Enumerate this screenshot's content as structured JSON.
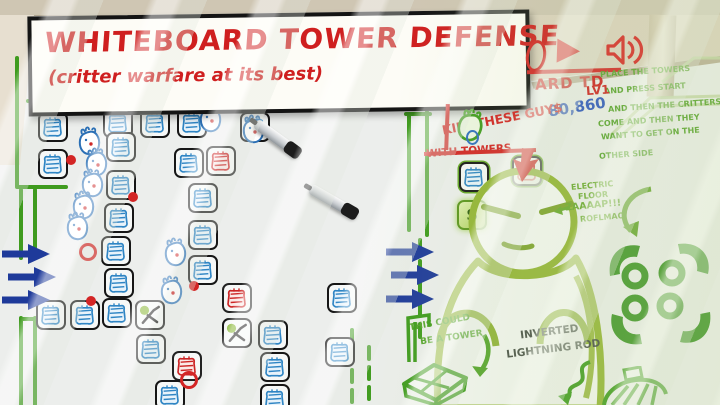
{
  "banner": {
    "title": "WHITEBOARD TOWER DEFENSE",
    "subtitle": "(critter warfare at its best)"
  },
  "hud": {
    "partial_board_label": "ARD TD",
    "score": "80,860",
    "kill_label": "KILL THESE GUY$",
    "with_label": "WITH TOWERS",
    "play_icon": "play-triangle",
    "sound_icon": "speaker-waves"
  },
  "instructions": {
    "level_label": "LV1",
    "lines": [
      "PLACE THE TOWERS",
      "AND PRESS START",
      "AND THEN THE CRITTERS",
      "COME AND THEN THEY",
      "WANT TO GET ON THE",
      "OTHER SIDE"
    ]
  },
  "annotations": {
    "electric_lines": [
      "ELECTRIC",
      "FLOOR",
      "ZAAAAP!!!",
      "ROFLMAO"
    ],
    "tower_idea_lines": [
      "THIS COULD",
      "BE A TOWER"
    ],
    "lightning_lines": [
      "INVERTED",
      "LIGHTNING ROD"
    ]
  },
  "palette": {
    "money_symbol": "$",
    "buttons": [
      {
        "x": 459,
        "y": 162,
        "t": "b"
      },
      {
        "x": 512,
        "y": 156,
        "t": "r"
      },
      {
        "x": 457,
        "y": 200,
        "t": "m"
      }
    ]
  },
  "colors": {
    "marker_red": "#d32525",
    "marker_blue": "#2f85c4",
    "marker_green": "#3f9b1e",
    "doodle_green": "#93b434",
    "score_blue": "#2d56c0",
    "arrow_navy": "#1e3a9a",
    "frame_beige": "#dcd2bf"
  },
  "board": {
    "towers": [
      {
        "x": 38,
        "y": 112,
        "t": "b"
      },
      {
        "x": 103,
        "y": 108,
        "t": "b"
      },
      {
        "x": 140,
        "y": 108,
        "t": "b"
      },
      {
        "x": 177,
        "y": 108,
        "t": "b"
      },
      {
        "x": 240,
        "y": 112,
        "t": "b"
      },
      {
        "x": 38,
        "y": 149,
        "t": "b"
      },
      {
        "x": 106,
        "y": 132,
        "t": "b"
      },
      {
        "x": 174,
        "y": 148,
        "t": "b"
      },
      {
        "x": 206,
        "y": 146,
        "t": "r"
      },
      {
        "x": 106,
        "y": 170,
        "t": "b"
      },
      {
        "x": 188,
        "y": 183,
        "t": "b"
      },
      {
        "x": 104,
        "y": 203,
        "t": "b"
      },
      {
        "x": 188,
        "y": 220,
        "t": "b"
      },
      {
        "x": 101,
        "y": 236,
        "t": "b"
      },
      {
        "x": 188,
        "y": 255,
        "t": "b"
      },
      {
        "x": 104,
        "y": 268,
        "t": "b"
      },
      {
        "x": 222,
        "y": 283,
        "t": "r"
      },
      {
        "x": 135,
        "y": 300,
        "t": "s"
      },
      {
        "x": 222,
        "y": 318,
        "t": "s"
      },
      {
        "x": 258,
        "y": 320,
        "t": "b"
      },
      {
        "x": 136,
        "y": 334,
        "t": "b"
      },
      {
        "x": 172,
        "y": 351,
        "t": "r"
      },
      {
        "x": 260,
        "y": 352,
        "t": "b"
      },
      {
        "x": 155,
        "y": 380,
        "t": "b"
      },
      {
        "x": 260,
        "y": 384,
        "t": "b"
      },
      {
        "x": 327,
        "y": 283,
        "t": "b"
      },
      {
        "x": 325,
        "y": 337,
        "t": "b"
      },
      {
        "x": 36,
        "y": 300,
        "t": "b"
      },
      {
        "x": 70,
        "y": 300,
        "t": "b"
      },
      {
        "x": 102,
        "y": 298,
        "t": "b"
      }
    ],
    "critters": [
      [
        197,
        103
      ],
      [
        240,
        114
      ],
      [
        76,
        126
      ],
      [
        83,
        147
      ],
      [
        79,
        168
      ],
      [
        70,
        190
      ],
      [
        64,
        211
      ],
      [
        162,
        237
      ],
      [
        158,
        275
      ]
    ],
    "projectiles": [
      {
        "x": 66,
        "y": 155,
        "ring": false
      },
      {
        "x": 128,
        "y": 192,
        "ring": false
      },
      {
        "x": 86,
        "y": 296,
        "ring": false
      },
      {
        "x": 189,
        "y": 281,
        "ring": false
      },
      {
        "x": 79,
        "y": 243,
        "ring": true
      },
      {
        "x": 180,
        "y": 371,
        "ring": true
      }
    ],
    "entry_arrows": [
      [
        0,
        243
      ],
      [
        6,
        266
      ],
      [
        0,
        289
      ]
    ],
    "exit_arrows": [
      [
        384,
        241
      ],
      [
        389,
        264
      ],
      [
        384,
        288
      ]
    ]
  }
}
